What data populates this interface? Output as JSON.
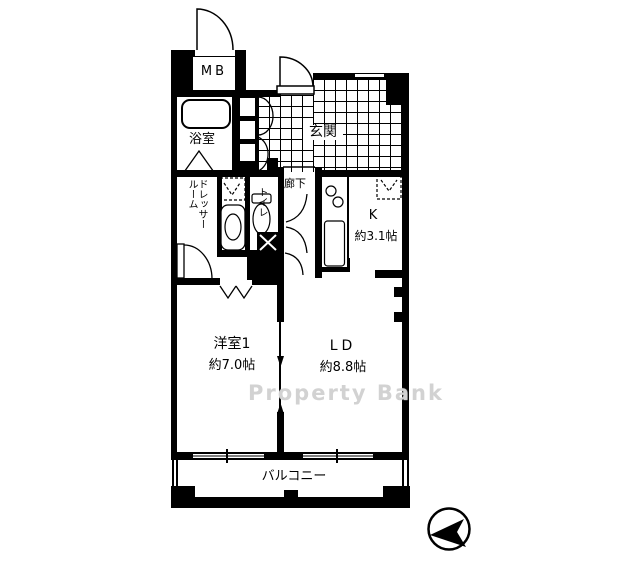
{
  "title": "apartment-floor-plan",
  "colors": {
    "wall": "#000000",
    "background": "#ffffff",
    "watermark": "#cdcdcd"
  },
  "watermark": {
    "text": "Property Bank"
  },
  "compass": {
    "icon": "compass-north-arrow-icon",
    "direction": "left"
  },
  "rooms": {
    "meter_box": {
      "label": "MB"
    },
    "bathroom": {
      "label": "浴室"
    },
    "entrance": {
      "label": "玄関"
    },
    "dresser_room": {
      "label": "ドレッサールーム",
      "label_line1": "ドレッサー",
      "label_line2": "ルーム"
    },
    "toilet": {
      "label": "トイレ"
    },
    "hallway": {
      "label": "廊下"
    },
    "kitchen": {
      "label": "K",
      "size": "約3.1帖"
    },
    "western_room1": {
      "label": "洋室1",
      "size": "約7.0帖"
    },
    "living_dining": {
      "label": "LD",
      "size": "約8.8帖"
    },
    "balcony": {
      "label": "バルコニー"
    }
  },
  "fixtures": {
    "bathtub": "bathtub-icon",
    "toilet_bowl": "toilet-icon",
    "washbasin": "washbasin-icon",
    "washing_machine_space": "washing-machine-space-icon",
    "kitchen_counter": "kitchen-sink-icon",
    "refrigerator_space": "refrigerator-space-icon",
    "pipe_space": "pipe-space-icon",
    "shoe_cabinet": "shoe-cabinet-icon"
  }
}
